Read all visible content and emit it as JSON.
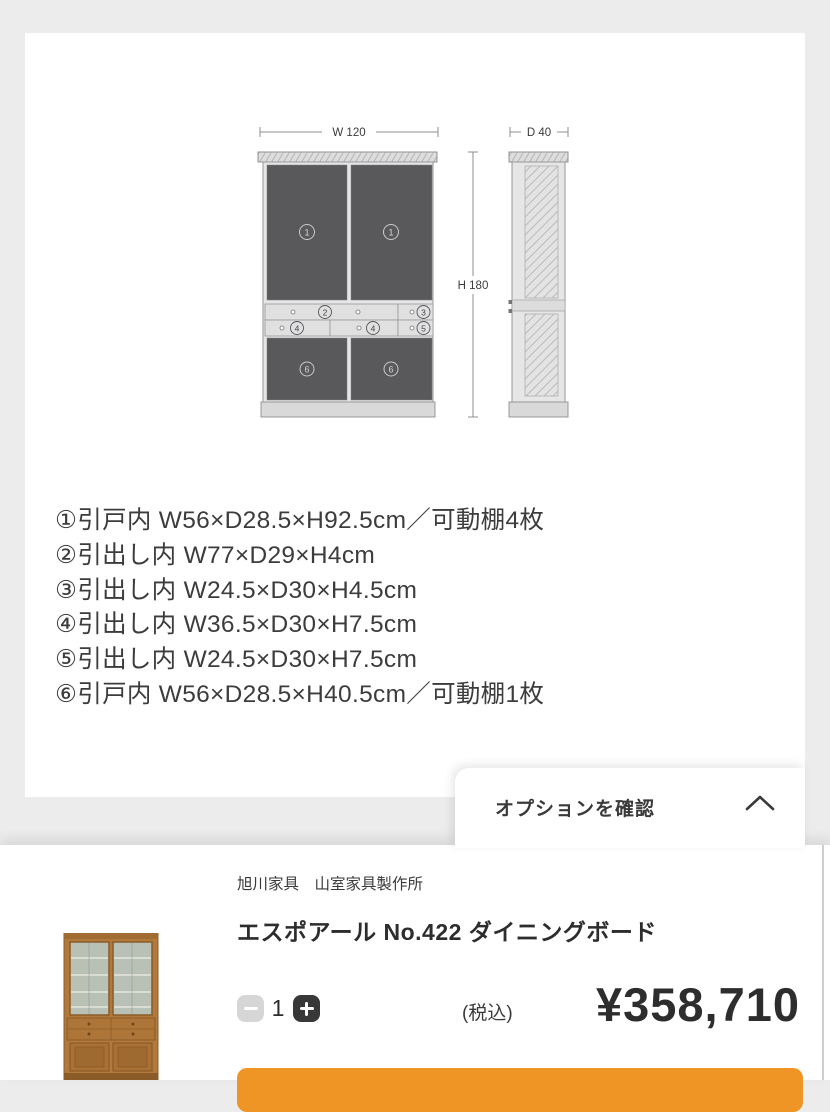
{
  "diagram": {
    "dim_width_label": "W 120",
    "dim_height_label": "H 180",
    "dim_depth_label": "D 40",
    "labels": {
      "door_top": "1",
      "drawer_wide": "2",
      "drawer_small_top": "3",
      "drawer_mid": "4",
      "drawer_small_bottom": "5",
      "door_bottom": "6"
    }
  },
  "specs": {
    "lines": [
      "①引戸内 W56×D28.5×H92.5cm／可動棚4枚",
      "②引出し内 W77×D29×H4cm",
      "③引出し内 W24.5×D30×H4.5cm",
      "④引出し内 W36.5×D30×H7.5cm",
      "⑤引出し内 W24.5×D30×H7.5cm",
      "⑥引戸内 W56×D28.5×H40.5cm／可動棚1枚"
    ]
  },
  "options_panel": {
    "label": "オプションを確認"
  },
  "purchase_bar": {
    "brand": "旭川家具　山室家具製作所",
    "product_name": "エスポアール No.422 ダイニングボード",
    "quantity": {
      "value": "1"
    },
    "price": {
      "tax_label": "(税込)",
      "amount": "¥358,710"
    },
    "accent_color": "#ef9526"
  }
}
